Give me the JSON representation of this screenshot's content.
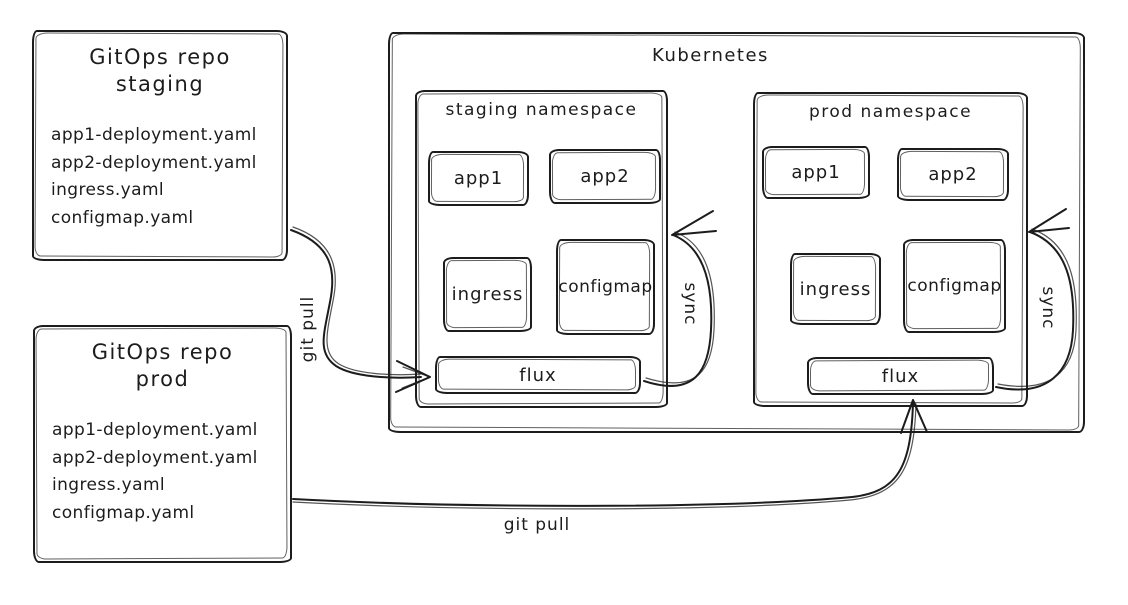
{
  "colors": {
    "ink": "#1c1c1c",
    "background": "#ffffff"
  },
  "repos": [
    {
      "title_line1": "GitOps repo",
      "title_line2": "staging",
      "files": [
        "app1-deployment.yaml",
        "app2-deployment.yaml",
        "ingress.yaml",
        "configmap.yaml"
      ]
    },
    {
      "title_line1": "GitOps repo",
      "title_line2": "prod",
      "files": [
        "app1-deployment.yaml",
        "app2-deployment.yaml",
        "ingress.yaml",
        "configmap.yaml"
      ]
    }
  ],
  "kubernetes": {
    "title": "Kubernetes",
    "namespaces": [
      {
        "title": "staging namespace",
        "workloads": [
          "app1",
          "app2"
        ],
        "resources": [
          "ingress",
          "configmap"
        ],
        "controller": "flux",
        "sync_label": "sync"
      },
      {
        "title": "prod namespace",
        "workloads": [
          "app1",
          "app2"
        ],
        "resources": [
          "ingress",
          "configmap"
        ],
        "controller": "flux",
        "sync_label": "sync"
      }
    ]
  },
  "edges": {
    "staging_git_pull": "git pull",
    "prod_git_pull": "git pull"
  }
}
